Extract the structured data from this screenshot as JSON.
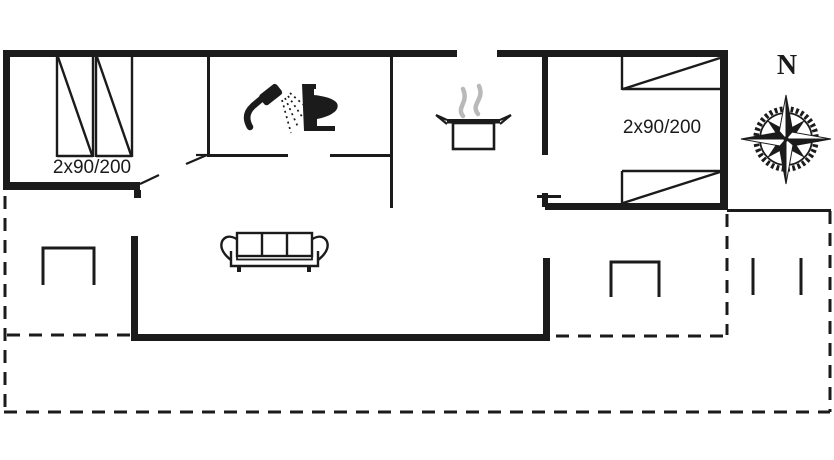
{
  "floor_plan": {
    "bedroom_left_label": "2x90/200",
    "bedroom_right_label": "2x90/200",
    "compass_north_label": "N",
    "colors": {
      "line": "#1b1b1b",
      "steam": "#b9b9b9",
      "background": "#ffffff"
    },
    "icons": {
      "shower": "shower-icon",
      "toilet": "toilet-icon",
      "cooking_pot": "cooking-pot-icon",
      "steam": "steam-icon",
      "sofa": "sofa-icon",
      "bed": "bed-icon",
      "terrace_table": "terrace-table-icon",
      "compass": "compass-rose-icon"
    }
  }
}
